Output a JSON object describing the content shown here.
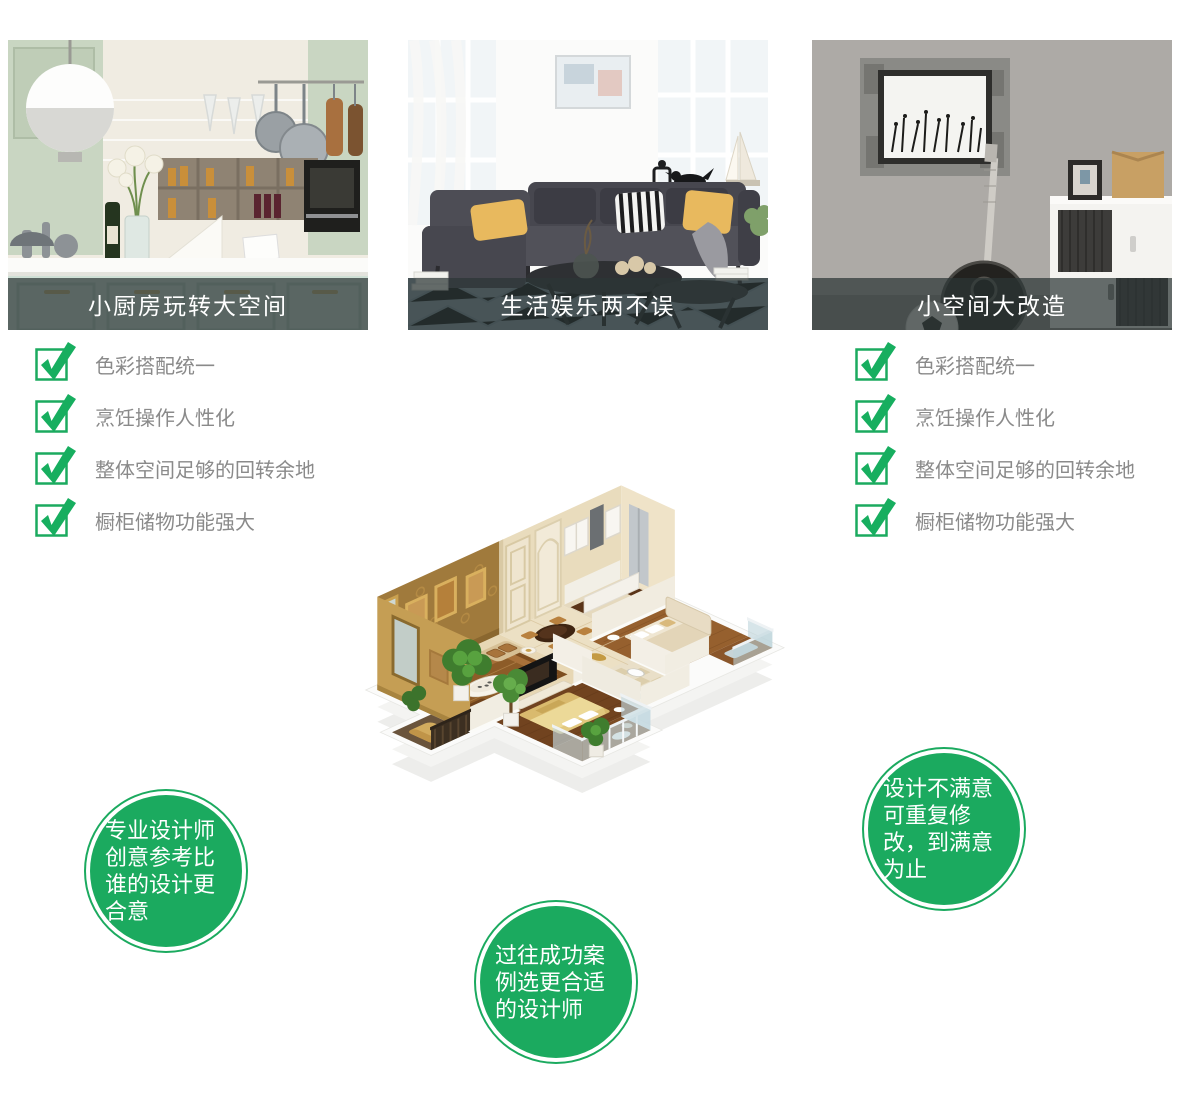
{
  "feature_cards": [
    {
      "caption": "小厨房玩转大空间"
    },
    {
      "caption": "生活娱乐两不误"
    },
    {
      "caption": "小空间大改造"
    }
  ],
  "checklists": {
    "left": {
      "items": [
        "色彩搭配统一",
        "烹饪操作人性化",
        "整体空间足够的回转余地",
        "橱柜储物功能强大"
      ]
    },
    "right": {
      "items": [
        "色彩搭配统一",
        "烹饪操作人性化",
        "整体空间足够的回转余地",
        "橱柜储物功能强大"
      ]
    }
  },
  "badges": [
    {
      "text": "专业设计师创意参考比谁的设计更合意"
    },
    {
      "text": "过往成功案例选更合适的设计师"
    },
    {
      "text": "设计不满意可重复修改，到满意为止"
    }
  ],
  "colors": {
    "accent_green": "#1baa5f",
    "checklist_text_grey": "#8a8a8a",
    "caption_overlay": "rgba(44,54,54,0.72)"
  }
}
